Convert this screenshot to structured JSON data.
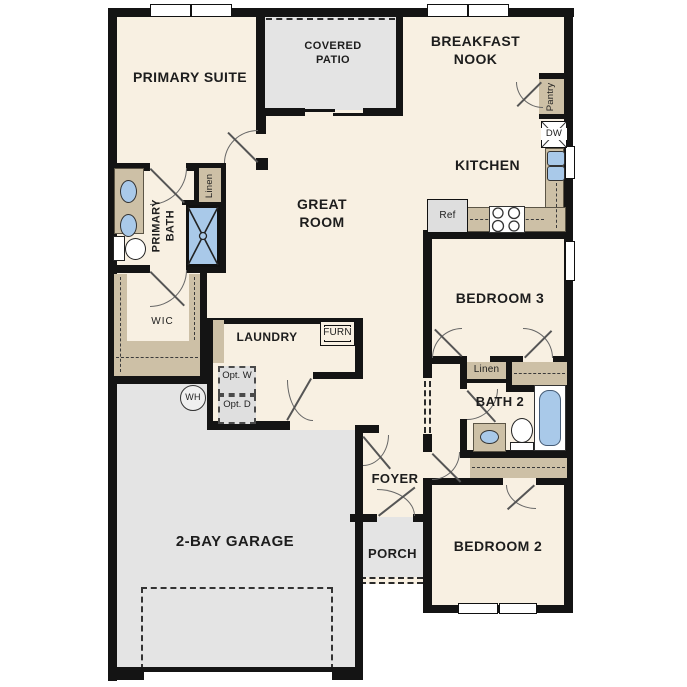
{
  "plan_title": "single-story floor plan",
  "labels": {
    "primary_suite": "PRIMARY SUITE",
    "covered_patio": "COVERED PATIO",
    "breakfast_nook": "BREAKFAST NOOK",
    "kitchen": "KITCHEN",
    "great_room": "GREAT ROOM",
    "primary_bath": "PRIMARY BATH",
    "linen_primary": "Linen",
    "wic": "WIC",
    "laundry": "LAUNDRY",
    "furn": "FURN",
    "opt_w": "Opt. W",
    "opt_d": "Opt. D",
    "wh": "WH",
    "pantry": "Pantry",
    "dw": "DW",
    "ref": "Ref",
    "bedroom3": "BEDROOM 3",
    "linen_hall": "Linen",
    "bath2": "BATH 2",
    "bedroom2": "BEDROOM 2",
    "foyer": "FOYER",
    "porch": "PORCH",
    "garage": "2-BAY GARAGE"
  },
  "colors": {
    "wall": "#141414",
    "interior_fill": "#f8f0e2",
    "outdoor_fill": "#e4e4e4",
    "casework_fill": "#cdc0a6",
    "fixture_blue": "#a9c9e9"
  }
}
